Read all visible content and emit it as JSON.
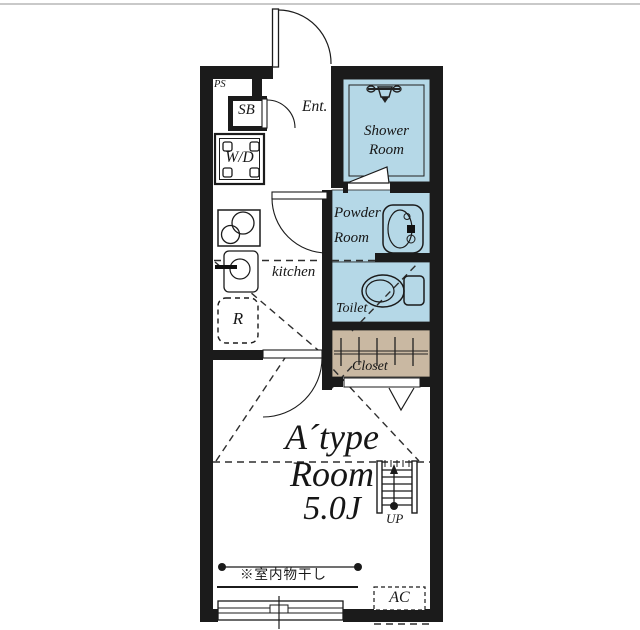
{
  "colors": {
    "wall": "#1b1b1b",
    "water_room_fill": "#b5d8e7",
    "closet_fill": "#c9b8a2",
    "page_top_border": "#c9c9c9"
  },
  "plan": {
    "pipe_space": "PS",
    "shoe_box": "SB",
    "entrance": "Ent.",
    "washer_dryer": "W/D",
    "shower_room_line1": "Shower",
    "shower_room_line2": "Room",
    "powder_room_line1": "Powder",
    "powder_room_line2": "Room",
    "toilet": "Toilet",
    "kitchen": "kitchen",
    "refrigerator": "R",
    "closet": "Closet",
    "stairs_up": "UP",
    "air_conditioner": "AC",
    "laundry_note": "※室内物干し",
    "room_type_line1": "A´type",
    "room_type_line2": "Room",
    "room_size": "5.0J"
  }
}
